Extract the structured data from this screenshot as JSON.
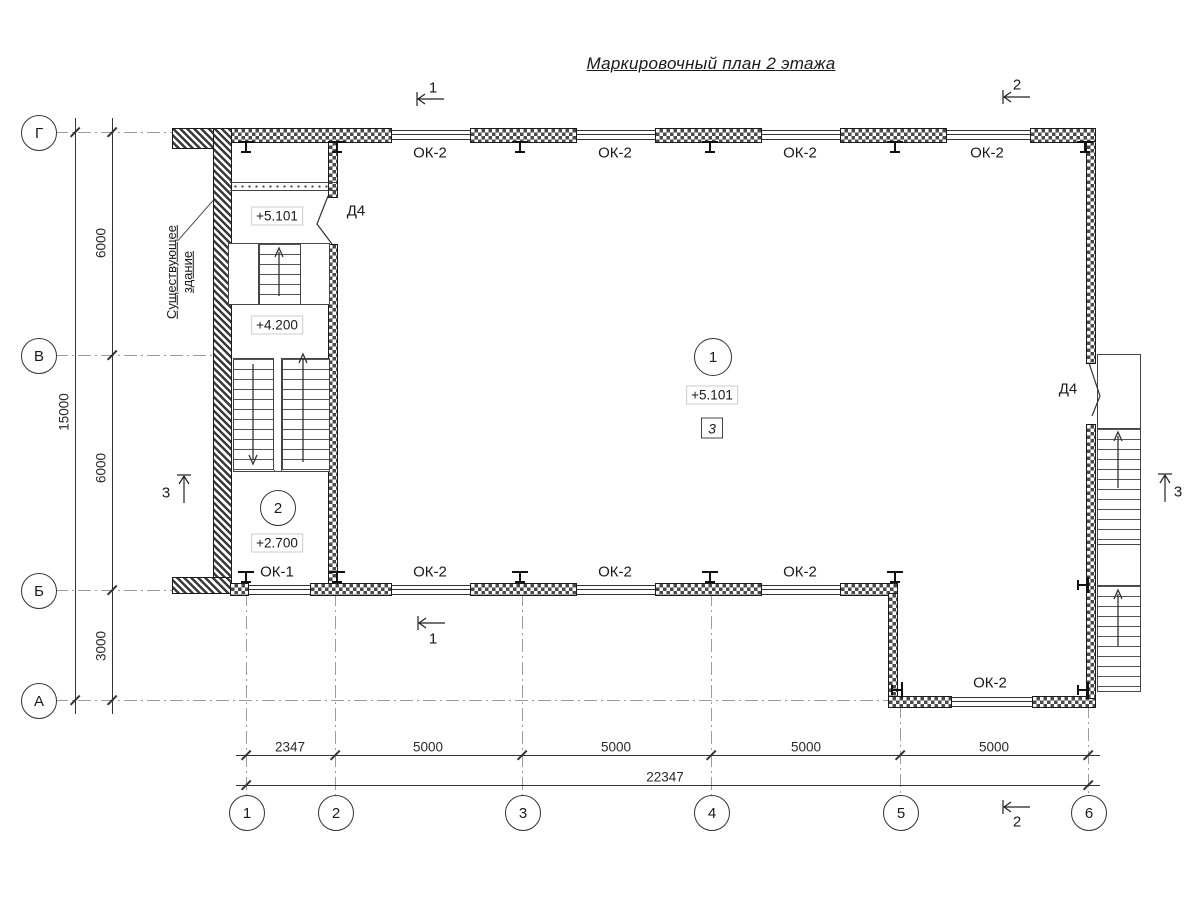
{
  "title": "Маркировочный план 2 этажа",
  "axes": {
    "rows": [
      "Г",
      "В",
      "Б",
      "А"
    ],
    "cols": [
      "1",
      "2",
      "3",
      "4",
      "5",
      "6"
    ]
  },
  "dims": {
    "left_segments": [
      "6000",
      "6000",
      "3000"
    ],
    "left_total": "15000",
    "bottom_segments": [
      "2347",
      "5000",
      "5000",
      "5000",
      "5000"
    ],
    "bottom_total": "22347"
  },
  "sections": {
    "s1": "1",
    "s2": "2",
    "s3": "3"
  },
  "rooms": {
    "hall_number": "1",
    "stair_number": "2",
    "note_box": "3"
  },
  "elevations": {
    "stair_upper": "+5.101",
    "stair_mid": "+4.200",
    "stair_lower": "+2.700",
    "hall": "+5.101"
  },
  "openings": {
    "window_ok1": "ОК-1",
    "window_ok2": "ОК-2",
    "door_d4": "Д4"
  },
  "labels": {
    "existing_line1": "Существующее",
    "existing_line2": "здание"
  }
}
